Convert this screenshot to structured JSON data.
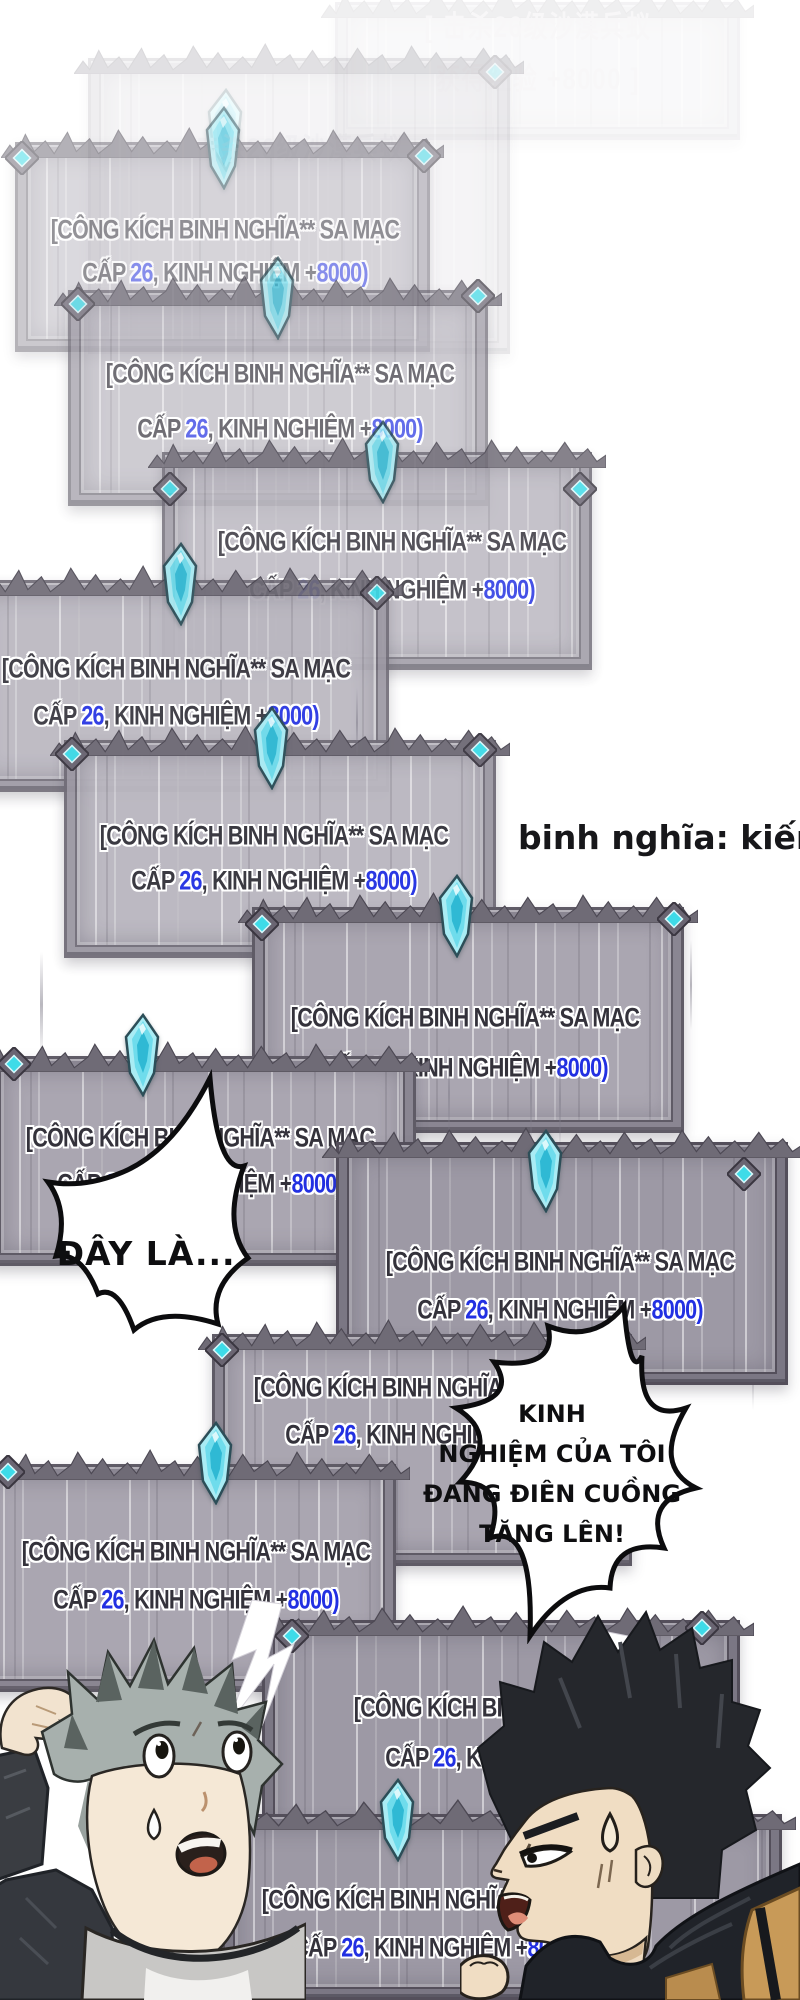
{
  "page": {
    "width": 800,
    "height": 2000,
    "background": "#ffffff"
  },
  "colors": {
    "panel_text_dark": "#34323b",
    "panel_text_blue": "#2230e2",
    "crystal_cyan": "#6fdcec",
    "gem_cyan": "#3edbe8",
    "bubble_fill": "#ffffff",
    "bubble_outline": "#0c0c0e"
  },
  "panel_text": {
    "line1": "[CÔNG KÍCH BINH NGHĨA** SA MẠC",
    "line2_parts": [
      {
        "t": "CẤP ",
        "blue": false
      },
      {
        "t": "26",
        "blue": true
      },
      {
        "t": ", KINH NGHIỆM ",
        "blue": false
      },
      {
        "t": "+",
        "blue": false
      },
      {
        "t": "8000)",
        "blue": true
      }
    ]
  },
  "faint_text": {
    "line1": "[ 击杀26级沙漠兵蚁",
    "line2": "获得经验 +8000 ]",
    "partial": "击杀26级沙漠兵蚁"
  },
  "note": {
    "text": "binh nghĩa: kiến lính"
  },
  "bubbles": [
    {
      "id": "bubble-day-la",
      "lines": [
        "ĐÂY LÀ..."
      ]
    },
    {
      "id": "bubble-kinh-nghiem",
      "lines": [
        "KINH",
        "NGHIỆM CỦA TÔI",
        "ĐANG ĐIÊN CUỒNG",
        "TĂNG LÊN!"
      ]
    }
  ],
  "panels": [
    {
      "id": "p1",
      "x": 335,
      "y": 2,
      "w": 405,
      "h": 138,
      "z": 1,
      "opacity": 0.1,
      "tier": "light",
      "crystal": null,
      "gems": [],
      "text": "cn",
      "l1y": 28,
      "l2y": 80,
      "cx": 538
    },
    {
      "id": "p2",
      "x": 88,
      "y": 58,
      "w": 422,
      "h": 296,
      "z": 2,
      "opacity": 0.2,
      "tier": "light",
      "crystal": {
        "cx": 226,
        "tip": 88
      },
      "gems": [
        {
          "x": 495,
          "y": 72
        }
      ],
      "text": "cn1",
      "l1y": 150,
      "l2y": 0,
      "cx": 300
    },
    {
      "id": "p3",
      "x": 15,
      "y": 142,
      "w": 415,
      "h": 210,
      "z": 3,
      "opacity": 0.52,
      "tier": "mid",
      "crystal": {
        "cx": 224,
        "tip": 106
      },
      "gems": [
        {
          "x": 22,
          "y": 158
        },
        {
          "x": 424,
          "y": 156
        }
      ],
      "text": "vn",
      "l1y": 230,
      "l2y": 273,
      "cx": 225
    },
    {
      "id": "p4",
      "x": 68,
      "y": 290,
      "w": 420,
      "h": 216,
      "z": 4,
      "opacity": 0.7,
      "tier": "mid",
      "crystal": {
        "cx": 278,
        "tip": 256
      },
      "gems": [
        {
          "x": 78,
          "y": 304
        },
        {
          "x": 478,
          "y": 296
        }
      ],
      "text": "vn",
      "l1y": 374,
      "l2y": 429,
      "cx": 280
    },
    {
      "id": "p5",
      "x": 162,
      "y": 452,
      "w": 430,
      "h": 218,
      "z": 5,
      "opacity": 0.84,
      "tier": "mid",
      "crystal": {
        "cx": 383,
        "tip": 420
      },
      "gems": [
        {
          "x": 170,
          "y": 489
        },
        {
          "x": 580,
          "y": 489
        }
      ],
      "text": "vn",
      "l1y": 542,
      "l2y": 590,
      "cx": 392
    },
    {
      "id": "p6",
      "x": -35,
      "y": 580,
      "w": 424,
      "h": 212,
      "z": 6,
      "opacity": 0.92,
      "tier": "mid",
      "crystal": {
        "cx": 181,
        "tip": 542
      },
      "gems": [
        {
          "x": 377,
          "y": 593
        }
      ],
      "text": "vn",
      "l1y": 669,
      "l2y": 716,
      "cx": 176
    },
    {
      "id": "p7",
      "x": 64,
      "y": 740,
      "w": 432,
      "h": 218,
      "z": 7,
      "opacity": 0.96,
      "tier": "mid",
      "crystal": {
        "cx": 272,
        "tip": 706
      },
      "gems": [
        {
          "x": 72,
          "y": 754
        },
        {
          "x": 480,
          "y": 750
        }
      ],
      "text": "vn",
      "l1y": 836,
      "l2y": 881,
      "cx": 274
    },
    {
      "id": "p8",
      "x": 252,
      "y": 907,
      "w": 432,
      "h": 226,
      "z": 8,
      "opacity": 1,
      "tier": "dark",
      "crystal": {
        "cx": 457,
        "tip": 874
      },
      "gems": [
        {
          "x": 262,
          "y": 924
        },
        {
          "x": 674,
          "y": 919
        }
      ],
      "text": "vn",
      "l1y": 1018,
      "l2y": 1068,
      "cx": 465
    },
    {
      "id": "p9",
      "x": -12,
      "y": 1056,
      "w": 428,
      "h": 210,
      "z": 9,
      "opacity": 1,
      "tier": "dark",
      "crystal": {
        "cx": 143,
        "tip": 1013
      },
      "gems": [
        {
          "x": 14,
          "y": 1064
        }
      ],
      "text": "vn",
      "l1y": 1138,
      "l2y": 1184,
      "cx": 200
    },
    {
      "id": "p10",
      "x": 336,
      "y": 1142,
      "w": 452,
      "h": 243,
      "z": 10,
      "opacity": 1,
      "tier": "darkest",
      "crystal": {
        "cx": 546,
        "tip": 1129
      },
      "gems": [
        {
          "x": 744,
          "y": 1174
        }
      ],
      "text": "vn",
      "l1y": 1262,
      "l2y": 1310,
      "cx": 560
    },
    {
      "id": "p11",
      "x": 212,
      "y": 1334,
      "w": 420,
      "h": 232,
      "z": 11,
      "opacity": 1,
      "tier": "dark",
      "crystal": null,
      "gems": [
        {
          "x": 222,
          "y": 1350
        }
      ],
      "text": "vn",
      "l1y": 1388,
      "l2y": 1435,
      "cx": 428
    },
    {
      "id": "p12",
      "x": -28,
      "y": 1464,
      "w": 424,
      "h": 228,
      "z": 12,
      "opacity": 1,
      "tier": "dark",
      "crystal": {
        "cx": 216,
        "tip": 1421
      },
      "gems": [
        {
          "x": 8,
          "y": 1472
        }
      ],
      "text": "vn",
      "l1y": 1552,
      "l2y": 1600,
      "cx": 196
    },
    {
      "id": "p13",
      "x": 262,
      "y": 1620,
      "w": 478,
      "h": 260,
      "z": 13,
      "opacity": 1,
      "tier": "darkest",
      "crystal": null,
      "gems": [
        {
          "x": 292,
          "y": 1636
        },
        {
          "x": 702,
          "y": 1628
        }
      ],
      "text": "vn",
      "l1y": 1708,
      "l2y": 1758,
      "cx": 528
    },
    {
      "id": "p14",
      "x": 222,
      "y": 1814,
      "w": 560,
      "h": 186,
      "z": 14,
      "opacity": 1,
      "tier": "darkest",
      "crystal": {
        "cx": 398,
        "tip": 1778
      },
      "gems": [],
      "text": "vn",
      "l1y": 1900,
      "l2y": 1948,
      "cx": 436
    }
  ],
  "streaks": [
    {
      "x": 40,
      "y": 952,
      "w": 3,
      "h": 105
    },
    {
      "x": 448,
      "y": 1046,
      "w": 2,
      "h": 96
    },
    {
      "x": 530,
      "y": 1038,
      "w": 2,
      "h": 112
    },
    {
      "x": 559,
      "y": 1050,
      "w": 2,
      "h": 100
    },
    {
      "x": 752,
      "y": 1292,
      "w": 2,
      "h": 118
    },
    {
      "x": 356,
      "y": 688,
      "w": 2,
      "h": 70
    },
    {
      "x": 300,
      "y": 1396,
      "w": 2,
      "h": 90
    },
    {
      "x": 690,
      "y": 940,
      "w": 2,
      "h": 90
    }
  ],
  "characters": [
    {
      "id": "left-character",
      "desc": "gray-haired boy scratching head, sweating, mouth open"
    },
    {
      "id": "right-character",
      "desc": "black-haired man in profile, shocked, sweat drop, raised fist"
    }
  ]
}
